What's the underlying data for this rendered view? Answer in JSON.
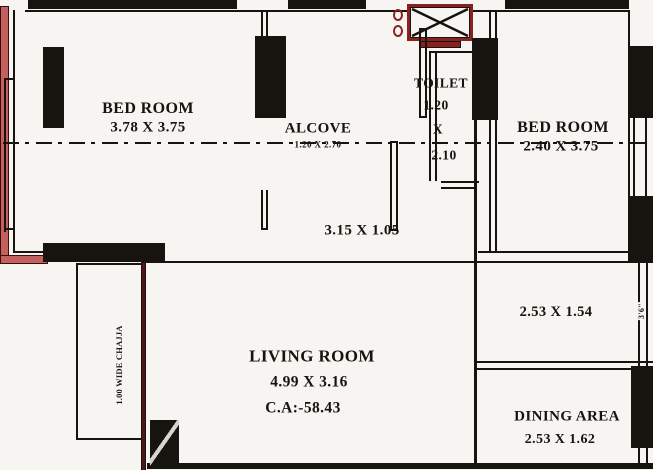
{
  "plan": {
    "rooms": {
      "bedroom_left": {
        "name": "BED ROOM",
        "dims": "3.78 X 3.75"
      },
      "alcove": {
        "name": "ALCOVE",
        "dims": "1.20 X 2.70"
      },
      "toilet": {
        "name": "TOILET",
        "width": "1.20",
        "sep": "X",
        "length": "2.10"
      },
      "bedroom_right": {
        "name": "BED ROOM",
        "dims": "2.40 X 3.75"
      },
      "passage": {
        "dims": "3.15 X 1.05"
      },
      "living_room": {
        "name": "LIVING ROOM",
        "dims": "4.99 X 3.16",
        "carpet_area": "C.A:-58.43"
      },
      "store": {
        "dims": "2.53 X 1.54"
      },
      "dining": {
        "name": "DINING AREA",
        "dims": "2.53 X 1.62"
      }
    },
    "annotations": {
      "chajja": "1.00 WIDE CHAJJA",
      "side_dim": "3'6\""
    },
    "icons": {
      "shaft": "shaft-cross-icon"
    },
    "colors": {
      "wall": "#17130f",
      "outer_red": "#c4615f",
      "dark_red": "#8b2020",
      "maroon": "#571418",
      "paper": "#f7f5f1"
    }
  }
}
